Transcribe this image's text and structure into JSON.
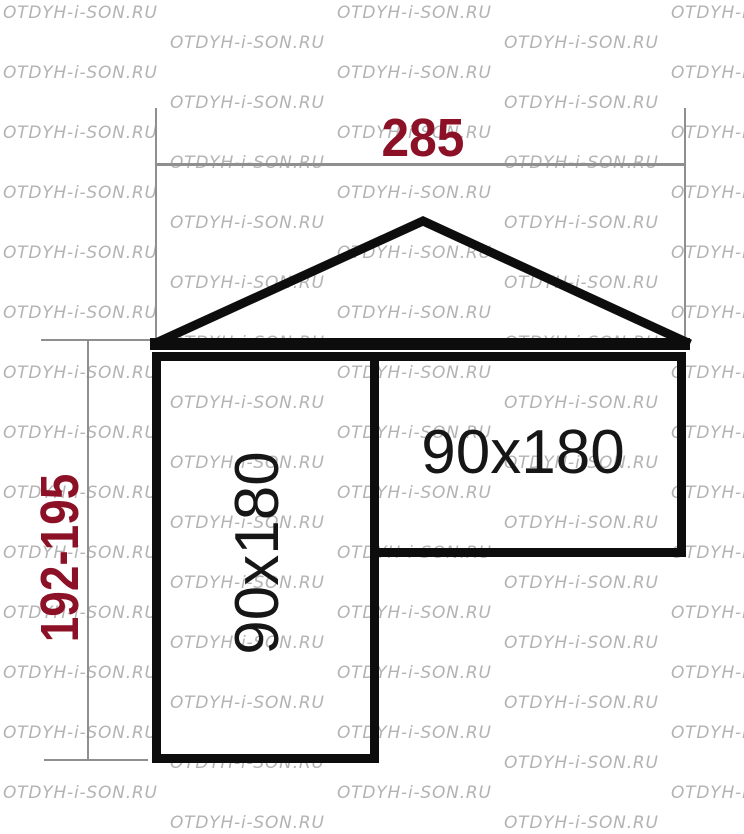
{
  "watermark": {
    "text": "OTDYH-i-SON.RU",
    "color": "#a6a6a6"
  },
  "diagram": {
    "width_label": "285",
    "height_label": "192-195",
    "left_bed_label": "90x180",
    "right_bed_label": "90x180",
    "label_color": "#8c1127",
    "shape_color": "#0d0d0d",
    "dim_line_color": "#8f8f8f"
  }
}
